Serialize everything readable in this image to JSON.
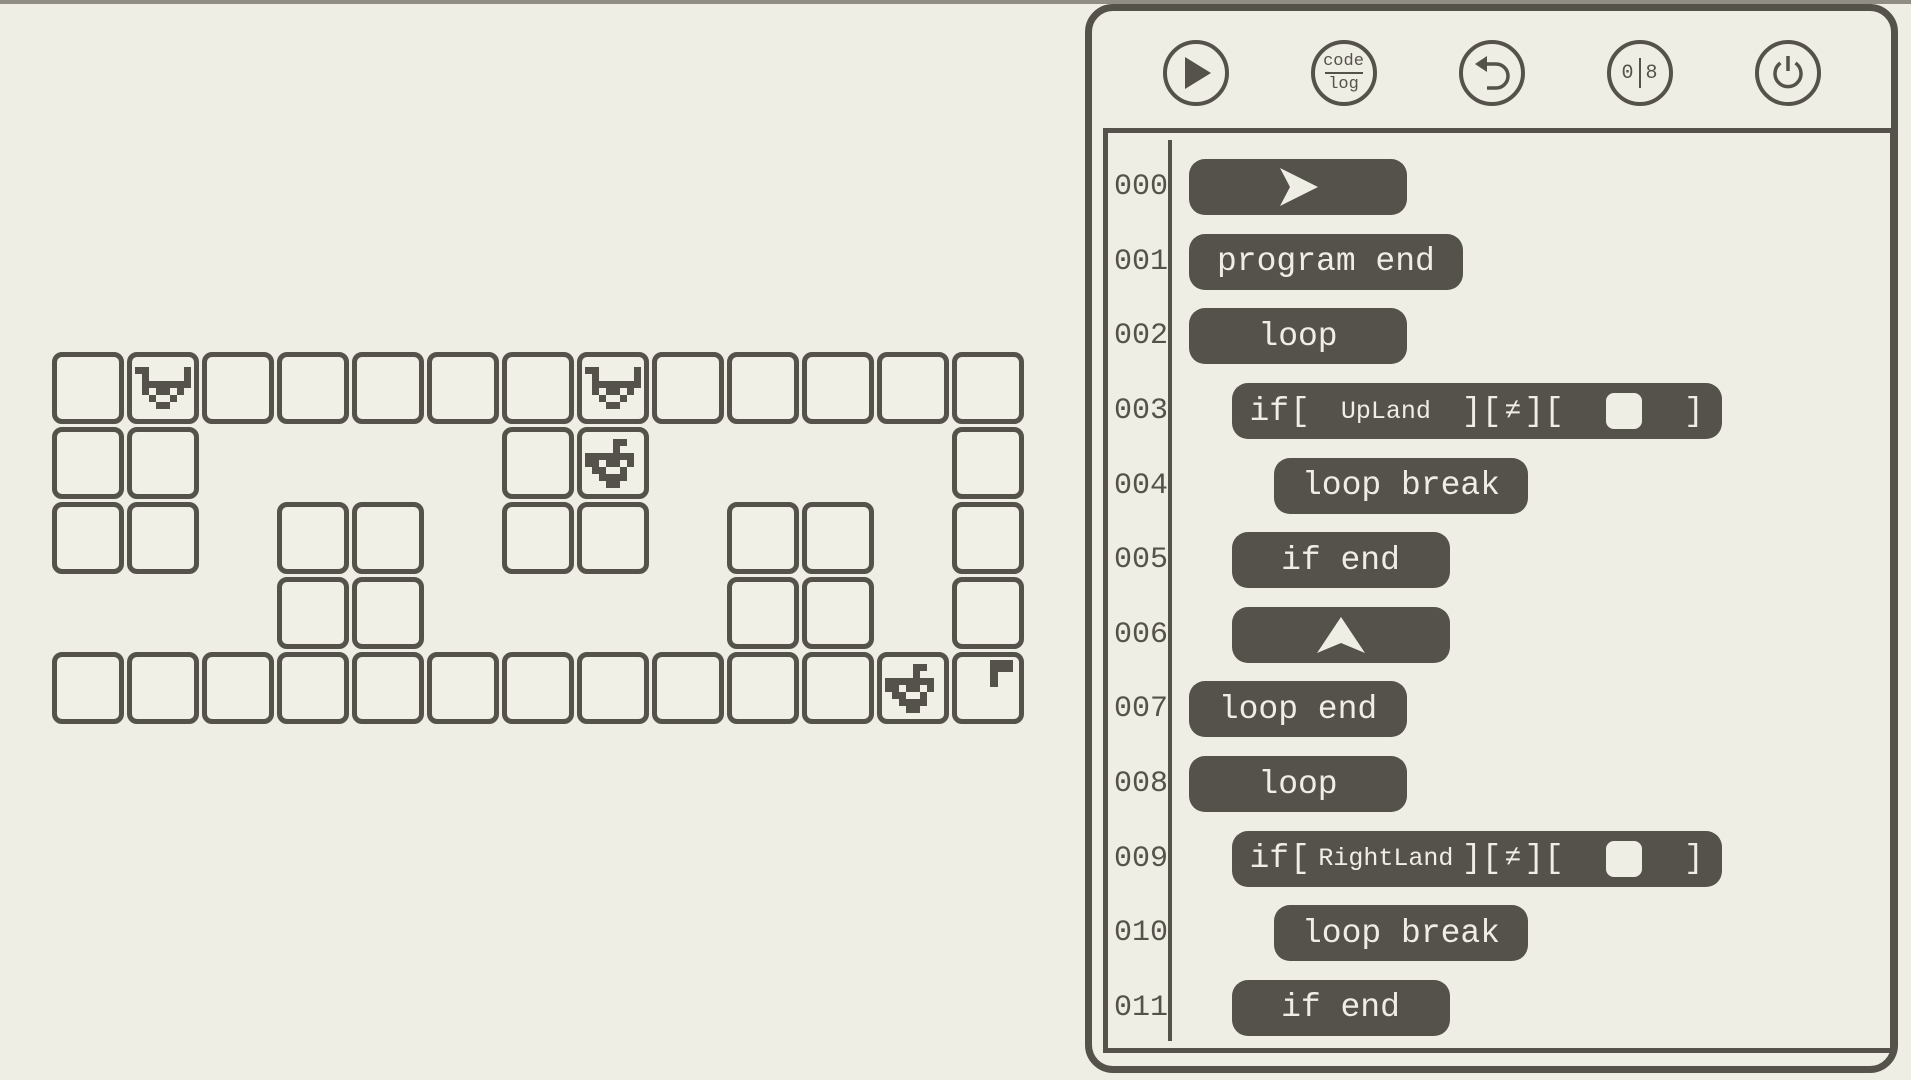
{
  "colors": {
    "background": "#EFEEE5",
    "ink": "#55524B",
    "tile_fill": "#F1F0E7",
    "pill_text": "#EFEEE5"
  },
  "toolbar": {
    "buttons": [
      {
        "id": "run",
        "icon": "play-icon"
      },
      {
        "id": "code-log",
        "icon": "code-log-icon",
        "line1": "code",
        "line2": "log"
      },
      {
        "id": "undo",
        "icon": "undo-icon"
      },
      {
        "id": "io-toggle",
        "icon": "binary-icon",
        "left": "0",
        "right": "8"
      },
      {
        "id": "power",
        "icon": "power-icon"
      }
    ]
  },
  "board": {
    "rows": 5,
    "cols": 13,
    "tiles": [
      "1111111111111",
      "1100001100001",
      "1101101101101",
      "0001100001101",
      "1111111111111"
    ],
    "entities": [
      {
        "sprite": "cow-up",
        "row": 0,
        "col": 1
      },
      {
        "sprite": "cow-up",
        "row": 0,
        "col": 7
      },
      {
        "sprite": "cow-down",
        "row": 1,
        "col": 7
      },
      {
        "sprite": "cow-down",
        "row": 4,
        "col": 11
      },
      {
        "sprite": "flag",
        "row": 4,
        "col": 12
      }
    ]
  },
  "program": {
    "lines": [
      {
        "num": "000",
        "indent": 0,
        "type": "icon",
        "icon": "forward-arrow-icon"
      },
      {
        "num": "001",
        "indent": 0,
        "type": "text",
        "label": "program end"
      },
      {
        "num": "002",
        "indent": 0,
        "type": "text",
        "label": "loop"
      },
      {
        "num": "003",
        "indent": 1,
        "type": "if",
        "keyword": "if",
        "b1": "[",
        "cond": "UpLand",
        "b2": "][",
        "op": "≠",
        "b3": "][",
        "value_icon": "empty-square-icon",
        "b4": "]"
      },
      {
        "num": "004",
        "indent": 2,
        "type": "text",
        "label": "loop break"
      },
      {
        "num": "005",
        "indent": 1,
        "type": "text",
        "label": "if end"
      },
      {
        "num": "006",
        "indent": 1,
        "type": "icon",
        "icon": "up-arrow-icon"
      },
      {
        "num": "007",
        "indent": 0,
        "type": "text",
        "label": "loop end"
      },
      {
        "num": "008",
        "indent": 0,
        "type": "text",
        "label": "loop"
      },
      {
        "num": "009",
        "indent": 1,
        "type": "if",
        "keyword": "if",
        "b1": "[",
        "cond": "RightLand",
        "b2": "][",
        "op": "≠",
        "b3": "][",
        "value_icon": "empty-square-icon",
        "b4": "]"
      },
      {
        "num": "010",
        "indent": 2,
        "type": "text",
        "label": "loop break"
      },
      {
        "num": "011",
        "indent": 1,
        "type": "text",
        "label": "if end"
      }
    ]
  }
}
